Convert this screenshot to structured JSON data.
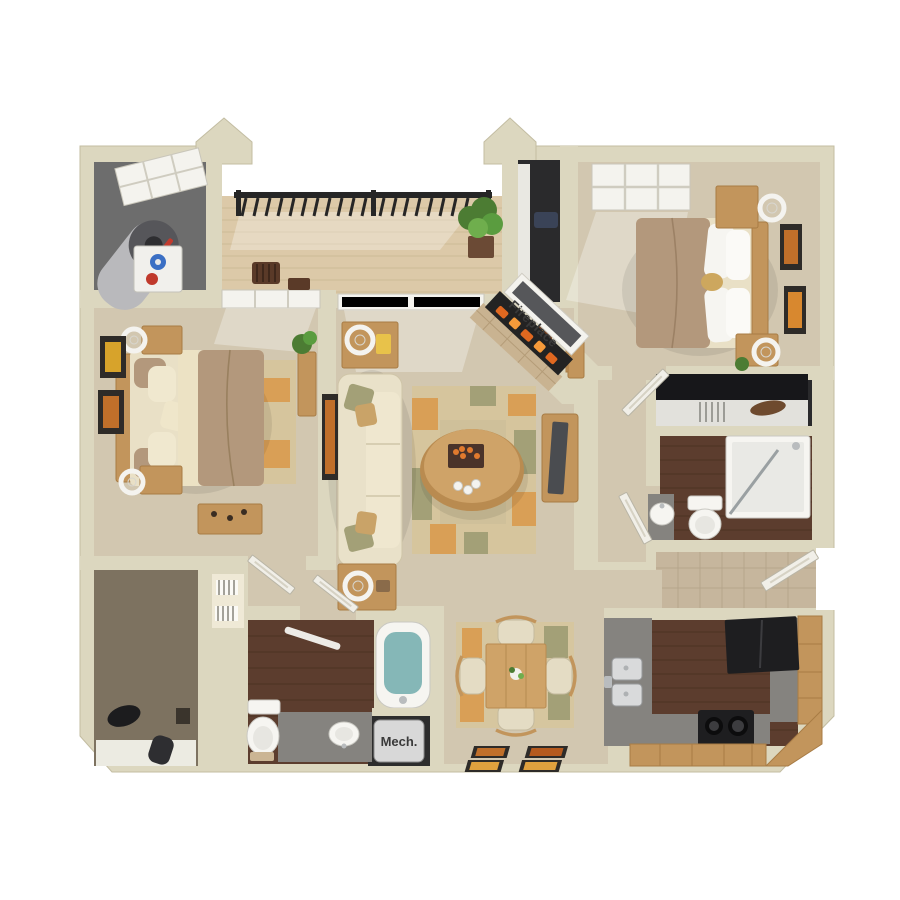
{
  "labels": {
    "fireplace": "Fireplace",
    "mech": "Mech."
  },
  "palette": {
    "background": "#ffffff",
    "wall": "#dcd7bf",
    "wall_edge": "#c3bda2",
    "carpet": "#d2c7b0",
    "carpet_dark": "#c5b9a0",
    "wood_floor": "#5c3d2e",
    "wood_floor_line": "#49301f",
    "deck": "#dcc9a8",
    "deck_line": "#c8b48f",
    "oak": "#c2955c",
    "oak_dark": "#a87c45",
    "counter": "#85837f",
    "appliance": "#1e1e20",
    "porcelain": "#f6f5f1",
    "water": "#85b7b7",
    "sofa": "#e9e1c9",
    "rug": "#d6c59d",
    "rug_olive": "#a3a077",
    "rug_orange": "#d99f56",
    "bed_taupe": "#b3987c",
    "bed_cream": "#e9e0c6",
    "linen": "#efe9d6",
    "frame": "#2e2b28",
    "art_orange": "#c06f2a",
    "plant": "#4c7c33",
    "railing": "#262626",
    "door": "#f1efe8",
    "tile": "#c6b69d",
    "closet_dark": "#2a2a2c",
    "label": "#3a3a3a"
  }
}
